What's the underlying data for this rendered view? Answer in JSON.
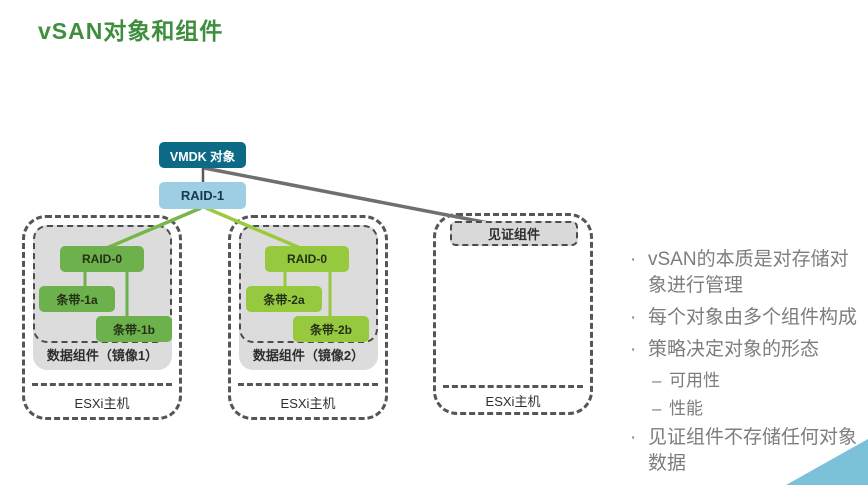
{
  "title": "vSAN对象和组件",
  "diagram": {
    "vmdk_label": "VMDK 对象",
    "raid1_label": "RAID-1",
    "hosts": [
      {
        "raid_label": "RAID-0",
        "stripe_a": "条带-1a",
        "stripe_b": "条带-1b",
        "group_label": "数据组件（镜像1）",
        "host_label": "ESXi主机"
      },
      {
        "raid_label": "RAID-0",
        "stripe_a": "条带-2a",
        "stripe_b": "条带-2b",
        "group_label": "数据组件（镜像2）",
        "host_label": "ESXi主机"
      },
      {
        "witness_label": "见证组件",
        "host_label": "ESXi主机"
      }
    ]
  },
  "bullets": {
    "bullet_marker": "·",
    "dash_marker": "–",
    "items": [
      {
        "level": 1,
        "text": "vSAN的本质是对存储对象进行管理"
      },
      {
        "level": 1,
        "text": "每个对象由多个组件构成"
      },
      {
        "level": 1,
        "text": "策略决定对象的形态"
      },
      {
        "level": 2,
        "text": "可用性"
      },
      {
        "level": 2,
        "text": "性能"
      },
      {
        "level": 1,
        "text": "见证组件不存储任何对象数据"
      }
    ]
  },
  "colors": {
    "title_green": "#3e8e3e",
    "vmdk_teal": "#0c6a87",
    "raid1_blue": "#9ecee3",
    "mirror1_green": "#6cb14c",
    "mirror2_green": "#97c93e",
    "gray_fill": "#dcdcdc",
    "dashed_border_gray": "#4c4c4c",
    "connector_gray": "#6f6f6f",
    "connector_green_left": "#79b649",
    "connector_green_right": "#9cca3d",
    "bullet_text_gray": "#7d7d7d",
    "corner_triangle_blue": "#7bc1da"
  }
}
